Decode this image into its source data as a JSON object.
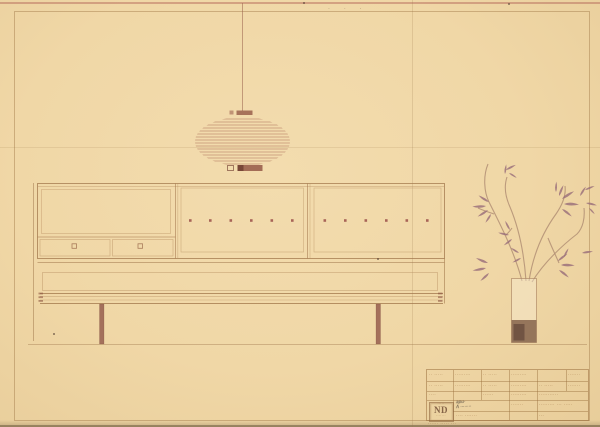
{
  "colors": {
    "paper": "#f0d7a6",
    "line_main": "#a57c4e",
    "line_light": "#c2a074",
    "accent_red": "#a05a4e",
    "leaf": "#9b7183",
    "vase_dark": "#8d6b53",
    "handwriting": "#4a4038"
  },
  "annotations": {
    "top_pencil_marks": "· · ·"
  },
  "illustrations": {
    "lamp": "striped-pendant-lamp-elevation",
    "cabinet": "three-section-sideboard-elevation",
    "bench": "long-bench-two-legs-elevation",
    "plant": "leafy-branches-in-tall-vase"
  },
  "title_block": {
    "logo": "ND",
    "logo_caption_top": "·····",
    "logo_caption_bottom": "·······",
    "logo_caption_below": "······ ····· ···",
    "row1": [
      "·· ·····",
      "·········",
      "·· ·····",
      "·········",
      "",
      "·······"
    ],
    "row2": [
      "·· ·····",
      "·········",
      "·· ·····",
      "·········",
      "·· ·····",
      "·······"
    ],
    "row3": [
      "····",
      "",
      "······",
      "·········",
      "···········"
    ],
    "handwriting_line1": "apu·",
    "handwriting_line2": "A ········",
    "cell_mid_bottom": "···· ·······",
    "cell_col4_bottom": "·······",
    "right_top": "········· ··· ·····",
    "right_bottom": "···"
  }
}
